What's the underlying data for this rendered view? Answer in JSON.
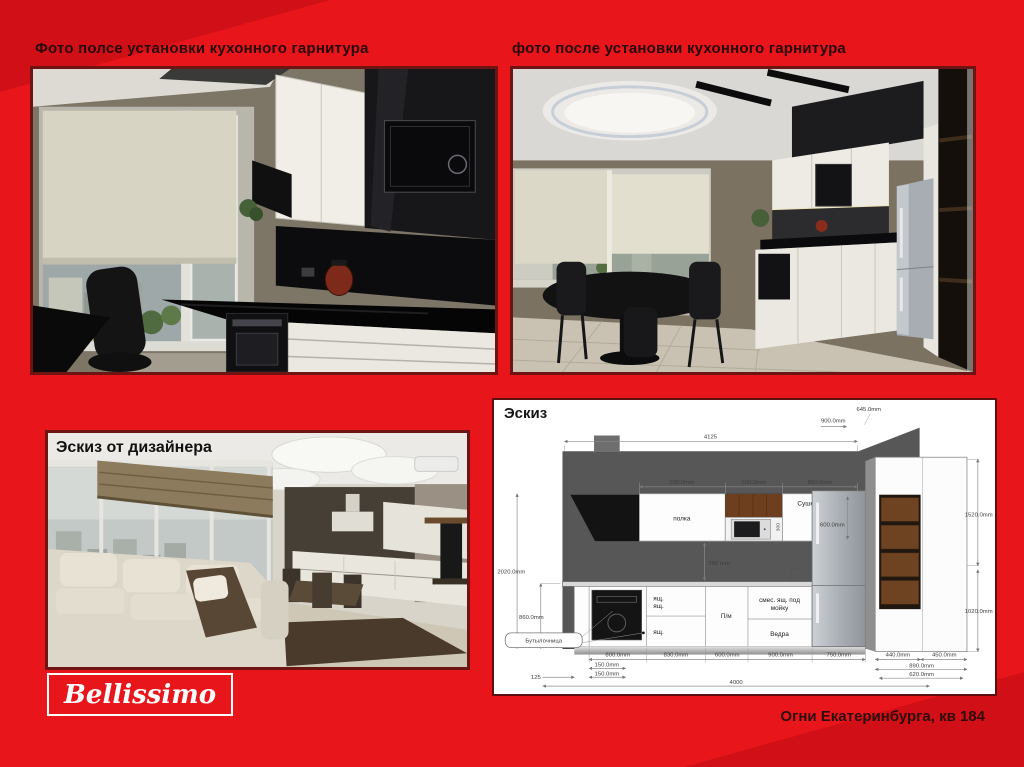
{
  "slide": {
    "caption_left": "Фото полсе установки кухонного гарнитура",
    "caption_right": "фото после установки кухонного гарнитура",
    "footer": "Огни Екатеринбурга, кв 184",
    "logo_text": "Bellissimo"
  },
  "photos": {
    "overlay_designer": "Эскиз от дизайнера"
  },
  "colors": {
    "slide_background": "#e8161b",
    "corner_accent": "#d01016",
    "photo_border": "#6e1413",
    "panel_border": "#5a1110",
    "heading_text": "#260808"
  },
  "sketch": {
    "title": "Эскиз",
    "labels": {
      "shelf": "полка",
      "dryer": "Сушка",
      "drawer_a1": "ящ.",
      "drawer_a2": "ящ.",
      "drawer_a3": "ящ.",
      "dishwasher": "П/м",
      "sink_l1": "смес. ящ. под",
      "sink_l2": "мойку",
      "buckets": "Ведра",
      "bottle": "Бутылочница"
    },
    "dims": {
      "total_top": "4125",
      "top_a": "645.0mm",
      "top_b": "900.0mm",
      "wall_1": "930.0mm",
      "wall_2": "600.0mm",
      "wall_3": "800.0mm",
      "dryer_h": "600.0mm",
      "niche_h": "300",
      "splash": "760 mm",
      "left_h": "2020.0mm",
      "counter_h": "860.0mm",
      "base_1": "800.0mm",
      "base_2": "830.0mm",
      "base_3": "600.0mm",
      "base_4": "900.0mm",
      "base_5": "750.0mm",
      "plinth_a": "150.0mm",
      "plinth_b": "125",
      "plinth_c": "150.0mm",
      "total_bottom": "4000",
      "tall_up": "1520.0mm",
      "tall_low": "1020.0mm",
      "tall_d1": "440.0mm",
      "tall_d2": "450.0mm",
      "tall_w1": "890.0mm",
      "tall_w2": "620.0mm"
    }
  }
}
